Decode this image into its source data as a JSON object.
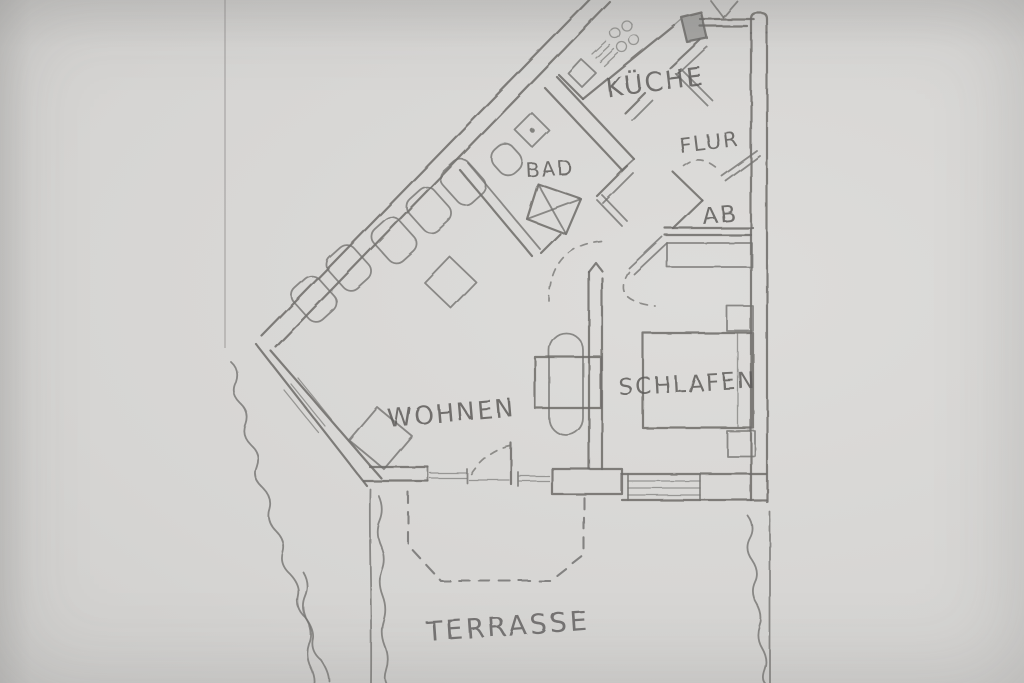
{
  "floor_plan": {
    "rooms": [
      {
        "id": "kueche",
        "label": "KÜCHE"
      },
      {
        "id": "flur",
        "label": "FLUR"
      },
      {
        "id": "ab",
        "label": "AB"
      },
      {
        "id": "bad",
        "label": "BAD"
      },
      {
        "id": "wohnen",
        "label": "WOHNEN"
      },
      {
        "id": "schlafen",
        "label": "SCHLAFEN"
      },
      {
        "id": "terrasse",
        "label": "TERRASSE"
      }
    ],
    "fixtures": [
      "stove-burners-icon",
      "kitchen-counter",
      "kitchen-sink-icon",
      "bath-sink-icon",
      "toilet-icon",
      "shower-icon",
      "dining-table",
      "chairs",
      "sofa-row",
      "side-table",
      "bed",
      "nightstands",
      "wardrobe",
      "entrance-door-icon",
      "door-swing-arcs",
      "terrace-outline",
      "garden-boundary"
    ],
    "colors": {
      "paper": "#d6d5d3",
      "pencil": "#6c6b69",
      "pencil_light": "#7b7a76"
    }
  }
}
